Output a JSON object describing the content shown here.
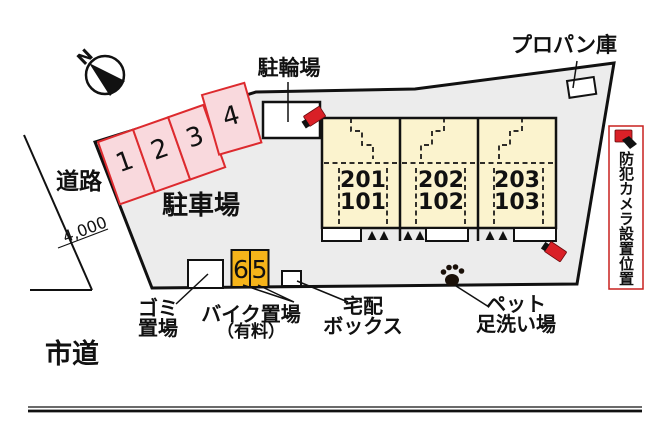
{
  "compass": {
    "north_label": "N"
  },
  "roads": {
    "left_road_label": "道路",
    "city_road_label": "市道",
    "road_width_dimension": "4,000"
  },
  "site": {
    "parking_area_label": "駐車場",
    "parking_space_numbers": [
      "1",
      "2",
      "3",
      "4"
    ],
    "bicycle_parking_label": "駐輪場",
    "propane_storage_label": "プロパン庫",
    "garbage_area_label": {
      "line1": "ゴミ",
      "line2": "置場"
    },
    "bike_parking_label": {
      "line1": "バイク置場",
      "line2": "（有料）"
    },
    "bike_space_numbers": [
      "6",
      "5"
    ],
    "delivery_box_label": {
      "line1": "宅配",
      "line2": "ボックス"
    },
    "pet_foot_wash_label": {
      "line1": "ペット",
      "line2": "足洗い場"
    },
    "building_units": [
      {
        "upper": "201",
        "lower": "101"
      },
      {
        "upper": "202",
        "lower": "102"
      },
      {
        "upper": "203",
        "lower": "103"
      }
    ]
  },
  "legend": {
    "security_camera_label": "防犯カメラ設置位置"
  },
  "colors": {
    "site_fill": "#ececec",
    "outline": "#111111",
    "parking_stall_fill": "#f9d9dd",
    "parking_stall_stroke": "#dd2a2e",
    "building_fill": "#fbf3ce",
    "bike_space_fill": "#f5b41a",
    "camera_red": "#d92027",
    "legend_border": "#c8201f"
  }
}
